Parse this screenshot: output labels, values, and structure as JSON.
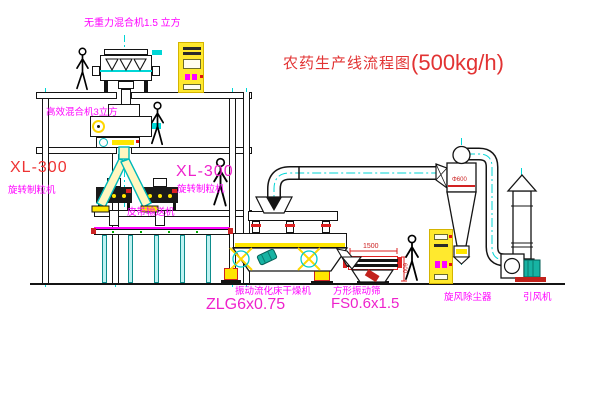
{
  "title": {
    "text_zh": "农药生产线流程图",
    "capacity": "(500kg/h)"
  },
  "equipment_labels": {
    "gravity_mixer": "无重力混合机1.5 立方",
    "efficient_mixer": "高效混合机3立方",
    "granulator_left_model": "XL-300",
    "granulator_left_name": "旋转制粒机",
    "granulator_center_model": "XL-300",
    "granulator_center_name": "旋转制粒机",
    "belt_conveyor": "皮带输送机",
    "dryer_name": "振动流化床干燥机",
    "dryer_model": "ZLG6x0.75",
    "screen_name": "方形振动筛",
    "screen_model": "FS0.6x1.5",
    "cyclone": "旋风除尘器",
    "fan": "引风机"
  },
  "dimensions": {
    "screen_length": "1500",
    "screen_height": "600",
    "cyclone_dia": "Φ600"
  },
  "colors": {
    "label_magenta": "#ff00ff",
    "title_red": "#e23333",
    "accent_red": "#cc2222",
    "centerline_cyan": "#00d6d6",
    "equipment_yellow": "#ffe600",
    "motor_teal": "#17b3a3"
  },
  "icons": {
    "person": "walking-person-silhouette",
    "flow_marker": "crosshair-circle-icon",
    "stack_cap": "rain-cap-triangle"
  }
}
